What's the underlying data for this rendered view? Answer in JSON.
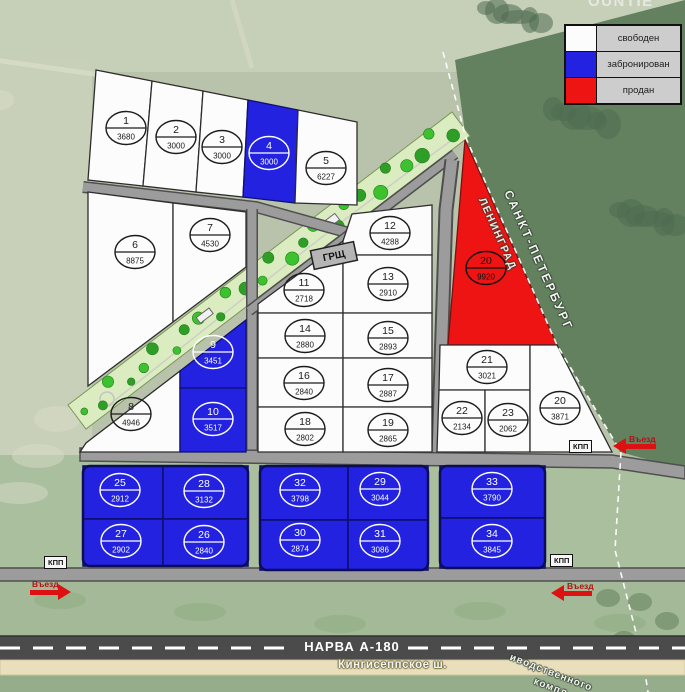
{
  "map": {
    "watermark": "OUNTIE",
    "legend": [
      {
        "label": "свободен",
        "status": "free"
      },
      {
        "label": "забронирован",
        "status": "reserved"
      },
      {
        "label": "продан",
        "status": "sold"
      }
    ],
    "statuses": {
      "free": "#fcfcfc",
      "reserved": "#2222e0",
      "sold": "#ee1414"
    },
    "plots": [
      {
        "id": "p1",
        "number": "1",
        "area": "3680",
        "status": "free"
      },
      {
        "id": "p2",
        "number": "2",
        "area": "3000",
        "status": "free"
      },
      {
        "id": "p3",
        "number": "3",
        "area": "3000",
        "status": "free"
      },
      {
        "id": "p4",
        "number": "4",
        "area": "3000",
        "status": "reserved"
      },
      {
        "id": "p5",
        "number": "5",
        "area": "6227",
        "status": "free"
      },
      {
        "id": "p6",
        "number": "6",
        "area": "8875",
        "status": "free"
      },
      {
        "id": "p7",
        "number": "7",
        "area": "4530",
        "status": "free"
      },
      {
        "id": "p8",
        "number": "8",
        "area": "4946",
        "status": "free"
      },
      {
        "id": "p9",
        "number": "9",
        "area": "3451",
        "status": "reserved"
      },
      {
        "id": "p10",
        "number": "10",
        "area": "3517",
        "status": "reserved"
      },
      {
        "id": "p11",
        "number": "11",
        "area": "2718",
        "status": "free"
      },
      {
        "id": "p12",
        "number": "12",
        "area": "4288",
        "status": "free"
      },
      {
        "id": "p13",
        "number": "13",
        "area": "2910",
        "status": "free"
      },
      {
        "id": "p14",
        "number": "14",
        "area": "2880",
        "status": "free"
      },
      {
        "id": "p15",
        "number": "15",
        "area": "2893",
        "status": "free"
      },
      {
        "id": "p16",
        "number": "16",
        "area": "2840",
        "status": "free"
      },
      {
        "id": "p17",
        "number": "17",
        "area": "2887",
        "status": "free"
      },
      {
        "id": "p18",
        "number": "18",
        "area": "2802",
        "status": "free"
      },
      {
        "id": "p19",
        "number": "19",
        "area": "2865",
        "status": "free"
      },
      {
        "id": "p20a",
        "number": "20",
        "area": "9920",
        "status": "sold"
      },
      {
        "id": "p21",
        "number": "21",
        "area": "3021",
        "status": "free"
      },
      {
        "id": "p22",
        "number": "22",
        "area": "2134",
        "status": "free"
      },
      {
        "id": "p23",
        "number": "23",
        "area": "2062",
        "status": "free"
      },
      {
        "id": "p20b",
        "number": "20",
        "area": "3871",
        "status": "free"
      },
      {
        "id": "p25",
        "number": "25",
        "area": "2912",
        "status": "reserved"
      },
      {
        "id": "p28",
        "number": "28",
        "area": "3132",
        "status": "reserved"
      },
      {
        "id": "p27",
        "number": "27",
        "area": "2902",
        "status": "reserved"
      },
      {
        "id": "p26",
        "number": "26",
        "area": "2840",
        "status": "reserved"
      },
      {
        "id": "p32",
        "number": "32",
        "area": "3798",
        "status": "reserved"
      },
      {
        "id": "p29",
        "number": "29",
        "area": "3044",
        "status": "reserved"
      },
      {
        "id": "p30",
        "number": "30",
        "area": "2874",
        "status": "reserved"
      },
      {
        "id": "p31",
        "number": "31",
        "area": "3086",
        "status": "reserved"
      },
      {
        "id": "p33",
        "number": "33",
        "area": "3790",
        "status": "reserved"
      },
      {
        "id": "p34",
        "number": "34",
        "area": "3845",
        "status": "reserved"
      }
    ],
    "infrastructure": {
      "grsch_label": "ГРЩ",
      "checkpoint_label": "КПП",
      "entrance_label": "Въезд"
    },
    "roads": {
      "highway_label": "НАРВА А-180",
      "road_label": "Кингисеппское ш."
    },
    "regions": {
      "right_of_border": "САНКТ-ПЕТЕРБУРГ",
      "left_of_border": "ЛЕНИНГРАД",
      "corner_line1": "иводственного",
      "corner_line2": "компл"
    }
  }
}
